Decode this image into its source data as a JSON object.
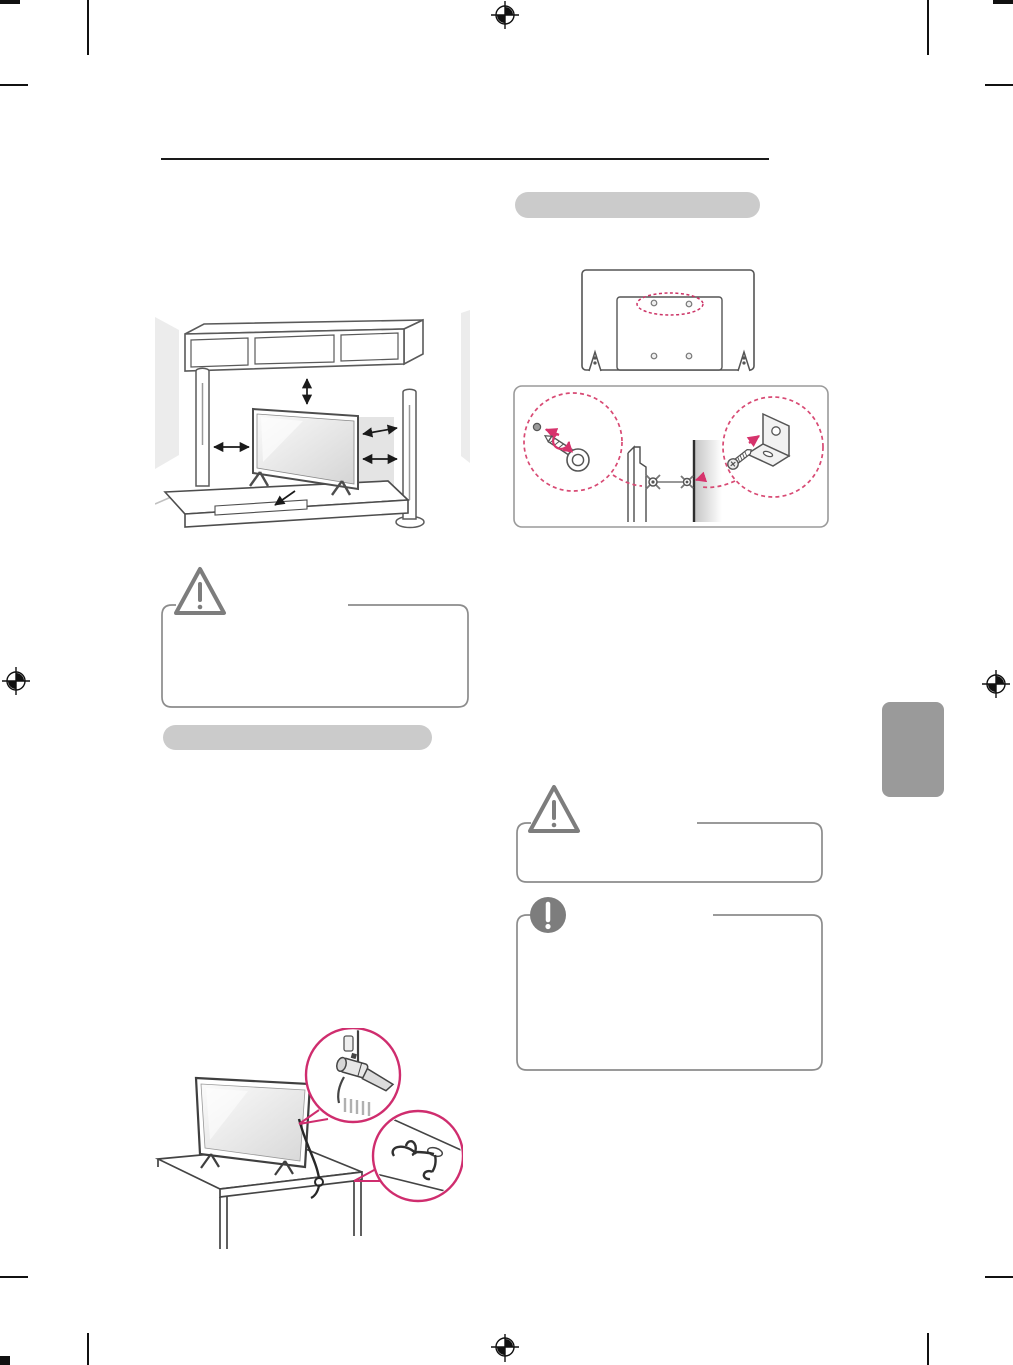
{
  "document": {
    "kind": "scanned user manual page",
    "page_title_text": "",
    "colors": {
      "page_bg": "#ffffff",
      "section_bar_gray": "#cbcbcb",
      "side_tab_gray": "#9a9a9a",
      "accent_pink": "#d6336c",
      "callout_dashed_pink": "#d84a74",
      "callout_solid_pink": "#cf2d6e",
      "line_art_gray": "#4d4d4d",
      "warning_icon_gray": "#7d7d7d",
      "box_border_gray": "#8c8c8c",
      "header_rule_black": "#1a1a1a"
    },
    "header": {
      "rule_present": true,
      "title_text": ""
    },
    "left_column": {
      "section_bar_label": "",
      "clearance_illustration": "tv-on-stand-with-shelf-and-speakers-clearance-arrows",
      "caution_box": {
        "title": "",
        "body": ""
      },
      "securing_illustration": "tv-secured-to-table-with-lock-and-cable-callouts"
    },
    "right_column": {
      "section_bar_label": "",
      "tv_rear_illustration": "tv-back-panel-with-mount-holes-dashed-ellipse",
      "hardware_illustration": "eye-bolt-and-wall-bracket-cord-anchoring",
      "caution_box": {
        "title": "",
        "body": ""
      },
      "note_box": {
        "title": "",
        "body": ""
      }
    },
    "side_tab_label": "",
    "print_marks": {
      "registration_targets": [
        "top-center",
        "left-middle",
        "right-middle",
        "bottom-center"
      ],
      "crop_marks": [
        "top-left",
        "top-right",
        "bottom-left",
        "bottom-right"
      ],
      "edge_ticks": [
        "left-upper",
        "right-upper",
        "left-lower",
        "right-lower"
      ]
    }
  }
}
